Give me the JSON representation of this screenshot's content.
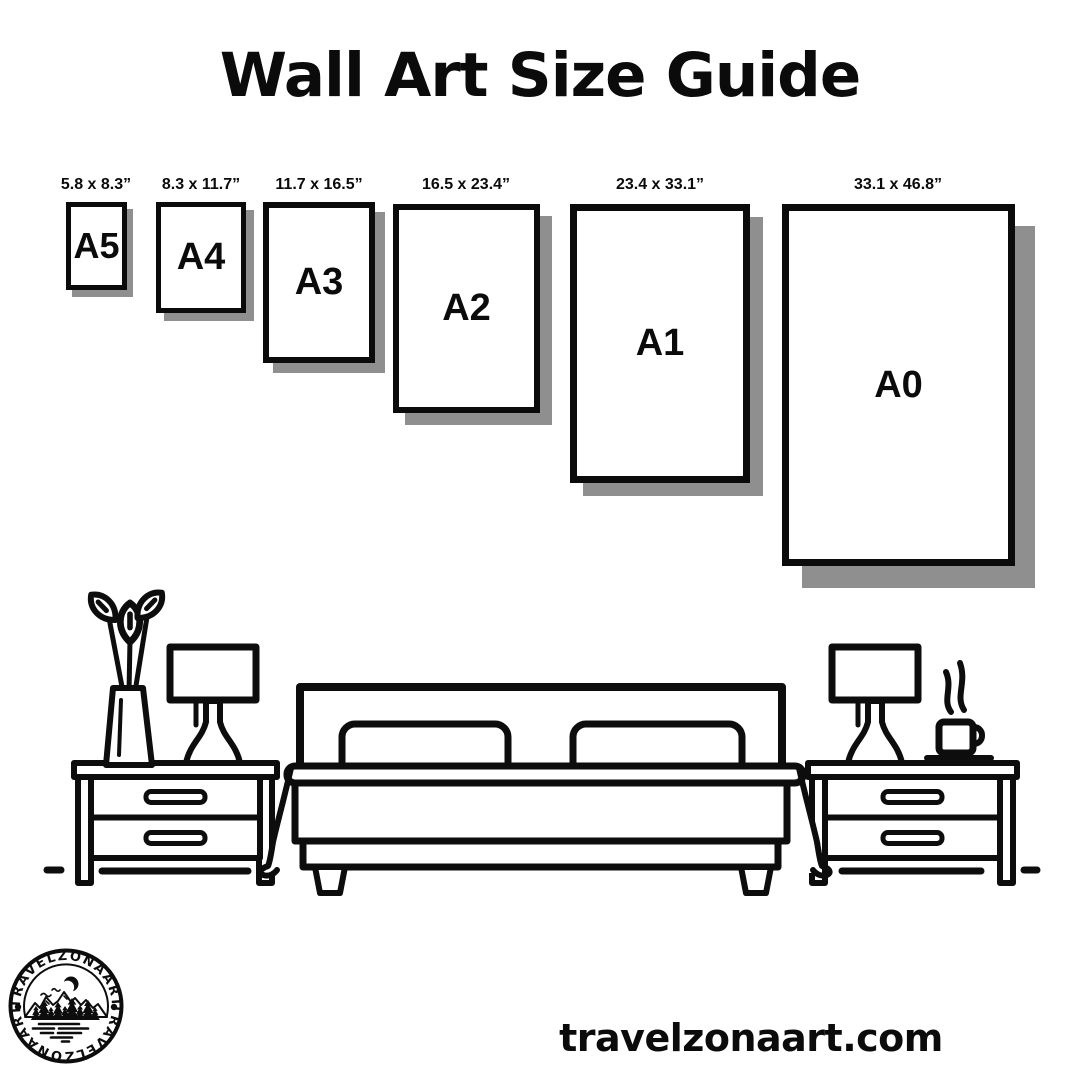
{
  "header": {
    "title": "Wall Art Size Guide"
  },
  "sizes": [
    {
      "code": "A5",
      "dimensions": "5.8 x 8.3”"
    },
    {
      "code": "A4",
      "dimensions": "8.3 x 11.7”"
    },
    {
      "code": "A3",
      "dimensions": "11.7 x 16.5”"
    },
    {
      "code": "A2",
      "dimensions": "16.5 x 23.4”"
    },
    {
      "code": "A1",
      "dimensions": "23.4 x 33.1”"
    },
    {
      "code": "A0",
      "dimensions": "33.1 x 46.8”"
    }
  ],
  "logo": {
    "brand": "TRAVELZONAART"
  },
  "footer": {
    "website": "travelzonaart.com"
  },
  "colors": {
    "ink": "#0d0d0d",
    "poster_shadow": "#8f8f8f",
    "background": "#ffffff"
  }
}
